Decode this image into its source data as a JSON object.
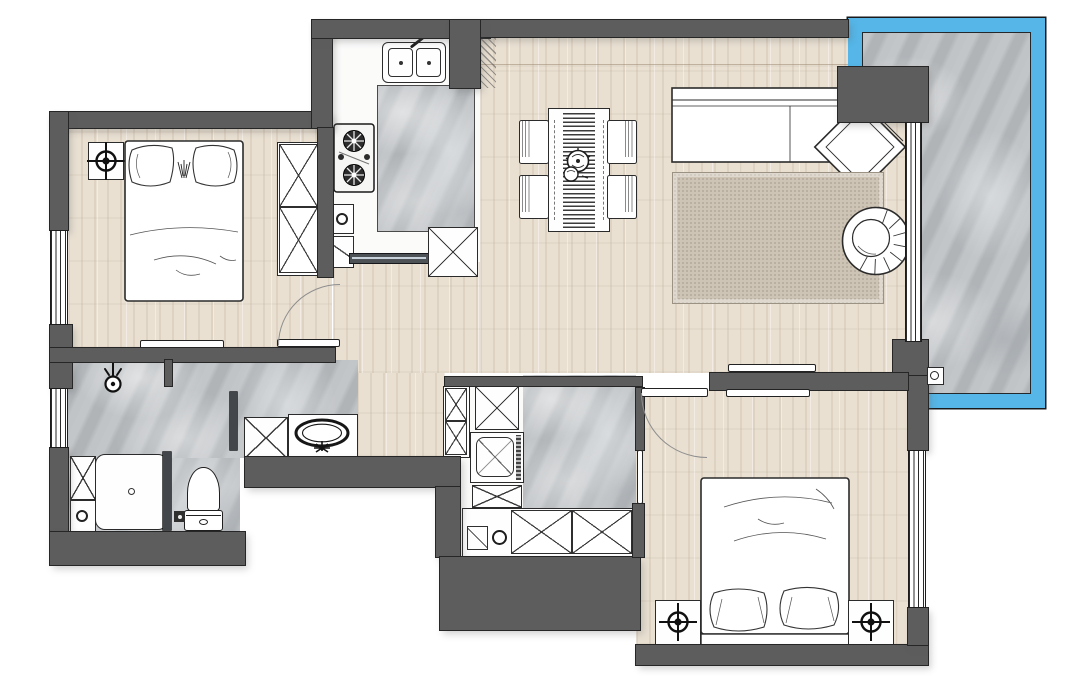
{
  "title": "apartment-floor-plan",
  "colors": {
    "wall": "#5d5d5d",
    "wall_outline": "#262626",
    "wood_floor": "#e9e0d2",
    "tile_floor": "#b6babd",
    "kitchen_floor": "#fbfbfa",
    "balcony_glass": "#55b6e7",
    "rug": "#cdc4b6",
    "furniture_fill": "#fefefe",
    "furniture_outline": "#2b2b2b",
    "door_arc": "#8e8e8e"
  },
  "rooms": [
    {
      "name": "bedroom-1",
      "position": "top-left",
      "floor": "wood",
      "furniture": [
        "double-bed",
        "pillows",
        "nightstand-with-lamp",
        "wardrobe-2-sections",
        "wall-shelf",
        "swing-door",
        "window"
      ]
    },
    {
      "name": "kitchen",
      "position": "top-center",
      "floor": "white-tile",
      "furniture": [
        "double-basin-sink",
        "gas-stove-2-burners",
        "marble-counter",
        "base-cabinet",
        "water-heater",
        "sliding-door"
      ]
    },
    {
      "name": "dining-area",
      "position": "center",
      "floor": "wood",
      "furniture": [
        "dining-table",
        "striped-table-runner",
        "centerpiece",
        "chair",
        "chair",
        "chair",
        "chair"
      ]
    },
    {
      "name": "living-room",
      "position": "center-right",
      "floor": "wood",
      "furniture": [
        "corner-sofa-with-chaise",
        "area-rug",
        "round-lounge-chair"
      ]
    },
    {
      "name": "balcony",
      "position": "right",
      "floor": "marble-tile",
      "furniture": [
        "glass-railing",
        "sliding-glass-door",
        "floor-drain"
      ]
    },
    {
      "name": "bathroom",
      "position": "bottom-left",
      "floor": "marble-tile",
      "furniture": [
        "shower-tray",
        "shower-head",
        "glass-partition",
        "toilet",
        "vanity-with-oval-basin",
        "storage-cabinet",
        "floor-drain",
        "window"
      ]
    },
    {
      "name": "laundry-utility",
      "position": "bottom-center",
      "floor": "marble-tile",
      "furniture": [
        "tall-cabinet-2-sections",
        "storage-box",
        "washing-machine",
        "counter-with-cabinets",
        "utility-sink",
        "door"
      ]
    },
    {
      "name": "bedroom-2",
      "position": "bottom-right",
      "floor": "wood",
      "furniture": [
        "double-bed-with-headboard",
        "pillows",
        "nightstand-with-lamp",
        "nightstand-with-lamp",
        "swing-door",
        "window",
        "wall-shelf"
      ]
    }
  ]
}
